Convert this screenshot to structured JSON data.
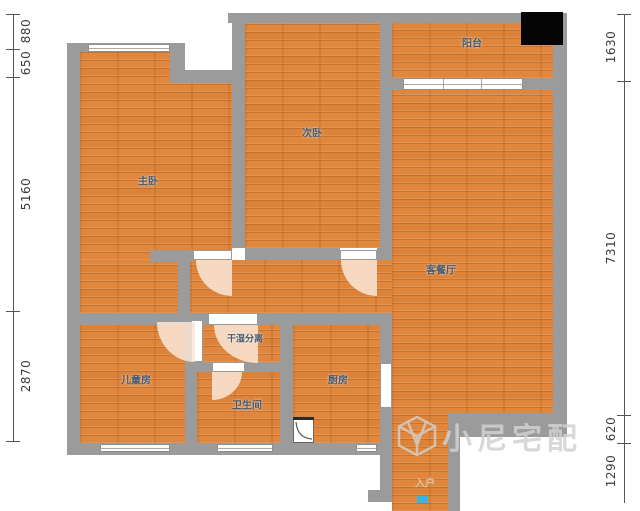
{
  "plan": {
    "rooms": {
      "master": {
        "label": "主卧"
      },
      "second_bedroom": {
        "label": "次卧"
      },
      "balcony": {
        "label": "阳台"
      },
      "living_dining": {
        "label": "客餐厅"
      },
      "wet_dry": {
        "label": "干湿分离"
      },
      "kids": {
        "label": "儿童房"
      },
      "bathroom": {
        "label": "卫生间"
      },
      "kitchen": {
        "label": "厨房"
      },
      "entry": {
        "label": "入户"
      }
    },
    "dimensions": {
      "left": [
        "880",
        "650",
        "5160",
        "2870"
      ],
      "right": [
        "1630",
        "7310",
        "620",
        "1290"
      ]
    },
    "watermark": {
      "text": "小尼宅配"
    },
    "colors": {
      "floor": "#e0873d",
      "wall": "#9b9b9b",
      "label": "#46586c",
      "door_swing": "#fae7d8",
      "entry_marker": "#3bb4d8",
      "corner_marker": "#050505",
      "watermark": "#d2d2d2"
    }
  }
}
